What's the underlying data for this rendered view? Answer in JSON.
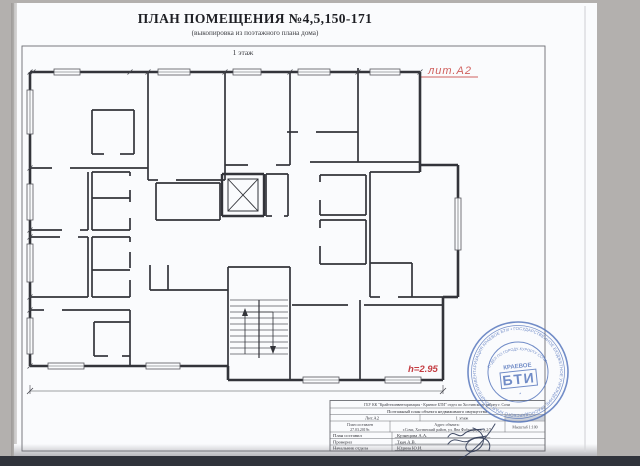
{
  "page": {
    "title": "ПЛАН ПОМЕЩЕНИЯ №4,5,150-171",
    "subtitle": "(выкопировка из поэтажного плана дома)",
    "floor_label": "1 этаж",
    "lit_label": "лит.А2",
    "height_label": "h=2.95"
  },
  "colors": {
    "paper": "#fafbfd",
    "background": "#b3b0ae",
    "wall": "#33343a",
    "dimension_text": "#45464d",
    "room_number_red": "#b8504f",
    "accent_red": "#c43c42",
    "stamp_blue": "#4b6db8",
    "bottom_band": "#30333b"
  },
  "plan": {
    "rooms": [
      {
        "n": "159",
        "a": "16.2",
        "x": 63,
        "y": 110
      },
      {
        "n": "160",
        "a": "2.2",
        "x": 108,
        "y": 116
      },
      {
        "n": "161",
        "a": "17.3",
        "x": 177,
        "y": 106
      },
      {
        "n": "164",
        "a": "13.0",
        "x": 250,
        "y": 112
      },
      {
        "n": "165",
        "a": "9.2",
        "x": 321,
        "y": 94
      },
      {
        "n": "166",
        "a": "13.8",
        "x": 383,
        "y": 110
      },
      {
        "n": "158",
        "a": "1.7",
        "x": 106,
        "y": 177
      },
      {
        "n": "156",
        "a": "7.0",
        "x": 60,
        "y": 199
      },
      {
        "n": "157",
        "a": "2.3",
        "x": 107,
        "y": 210
      },
      {
        "n": "162",
        "a": "5.6",
        "x": 192,
        "y": 192
      },
      {
        "n": "163",
        "a": "1.5",
        "x": 276,
        "y": 192
      },
      {
        "n": "167",
        "a": "4.2",
        "x": 343,
        "y": 186
      },
      {
        "n": "168",
        "a": "4.2",
        "x": 343,
        "y": 234
      },
      {
        "n": "169",
        "a": "18.6",
        "x": 414,
        "y": 220
      },
      {
        "n": "155",
        "a": "6.9",
        "x": 58,
        "y": 260
      },
      {
        "n": "154",
        "a": "2.3",
        "x": 108,
        "y": 246
      },
      {
        "n": "153",
        "a": "1.8",
        "x": 107,
        "y": 279
      },
      {
        "n": "152",
        "a": "13.5",
        "x": 65,
        "y": 336
      },
      {
        "n": "151",
        "a": "2.2",
        "x": 108,
        "y": 336
      },
      {
        "n": "150",
        "a": "17.3",
        "x": 182,
        "y": 335
      },
      {
        "n": "4",
        "a": "43.2",
        "x": 255,
        "y": 242
      },
      {
        "n": "5",
        "a": "9.2",
        "x": 250,
        "y": 362
      },
      {
        "n": "171",
        "a": "14.3",
        "x": 324,
        "y": 334
      },
      {
        "n": "170",
        "a": "15.4",
        "x": 413,
        "y": 334
      }
    ],
    "dims": [
      {
        "t": "4.21",
        "x": 110,
        "y": 69
      },
      {
        "t": "4.14",
        "x": 197,
        "y": 69
      },
      {
        "t": "2.86",
        "x": 253,
        "y": 71
      },
      {
        "t": "3.23",
        "x": 322,
        "y": 70
      },
      {
        "t": "1.75",
        "x": 103,
        "y": 100
      },
      {
        "t": "1.56",
        "x": 100,
        "y": 113
      },
      {
        "t": "1.45",
        "x": 139,
        "y": 132
      },
      {
        "t": "1.49",
        "x": 268,
        "y": 138
      },
      {
        "t": "1.75",
        "x": 343,
        "y": 137
      },
      {
        "t": "4.16",
        "x": 366,
        "y": 158
      },
      {
        "t": "1.90",
        "x": 444,
        "y": 162
      },
      {
        "t": "2.97",
        "x": 191,
        "y": 182
      },
      {
        "t": "2.52",
        "x": 61,
        "y": 176
      },
      {
        "t": "1.57",
        "x": 107,
        "y": 192
      },
      {
        "t": "1.65",
        "x": 96,
        "y": 203
      },
      {
        "t": "2.50",
        "x": 61,
        "y": 242
      },
      {
        "t": "1.56",
        "x": 107,
        "y": 237
      },
      {
        "t": "1.60",
        "x": 108,
        "y": 272
      },
      {
        "t": ".80",
        "x": 276,
        "y": 178
      },
      {
        "t": "2.00",
        "x": 342,
        "y": 173
      },
      {
        "t": "2.00",
        "x": 342,
        "y": 219
      },
      {
        "t": "3.78",
        "x": 412,
        "y": 186
      },
      {
        "t": "6.18",
        "x": 219,
        "y": 227
      },
      {
        "t": "3.10",
        "x": 190,
        "y": 267
      },
      {
        "t": "1.67",
        "x": 391,
        "y": 259
      },
      {
        "t": "3.99",
        "x": 363,
        "y": 272
      },
      {
        "t": "1.40",
        "x": 391,
        "y": 288
      },
      {
        "t": "3.65",
        "x": 337,
        "y": 288
      },
      {
        "t": "3.63",
        "x": 330,
        "y": 303
      },
      {
        "t": "3.90",
        "x": 415,
        "y": 301
      },
      {
        "t": "1.15",
        "x": 244,
        "y": 302
      },
      {
        "t": "4.20",
        "x": 77,
        "y": 306
      },
      {
        "t": "1.76",
        "x": 101,
        "y": 318
      },
      {
        "t": "1.22",
        "x": 140,
        "y": 316
      },
      {
        "t": "1.56",
        "x": 100,
        "y": 329
      },
      {
        "t": "1.38",
        "x": 142,
        "y": 331
      },
      {
        "t": "4.13",
        "x": 173,
        "y": 378
      },
      {
        "t": "2.35",
        "x": 244,
        "y": 378
      },
      {
        "t": "20.40",
        "x": 244,
        "y": 399
      },
      {
        "t": "4.58",
        "x": 36,
        "y": 120,
        "r": 1
      },
      {
        "t": "1.76",
        "x": 82,
        "y": 128,
        "r": 1
      },
      {
        "t": "1.43",
        "x": 119,
        "y": 128,
        "r": 1
      },
      {
        "t": "4.82",
        "x": 213,
        "y": 120,
        "r": 1
      },
      {
        "t": "1.70",
        "x": 165,
        "y": 152,
        "r": 1
      },
      {
        "t": "2.86",
        "x": 352,
        "y": 98,
        "r": 1
      },
      {
        "t": "3.04",
        "x": 367,
        "y": 97,
        "r": 1
      },
      {
        "t": "4.55",
        "x": 279,
        "y": 114,
        "r": 1
      },
      {
        "t": "4.54",
        "x": 407,
        "y": 111,
        "r": 1
      },
      {
        "t": "5.01",
        "x": 428,
        "y": 111,
        "r": 1
      },
      {
        "t": "1.12",
        "x": 95,
        "y": 181,
        "r": 1
      },
      {
        "t": "2.79",
        "x": 86,
        "y": 204,
        "r": 1
      },
      {
        "t": "1.49",
        "x": 122,
        "y": 214,
        "r": 1
      },
      {
        "t": "1.87",
        "x": 219,
        "y": 197,
        "r": 1
      },
      {
        "t": "1.92",
        "x": 283,
        "y": 197,
        "r": 1
      },
      {
        "t": "4.00",
        "x": 294,
        "y": 182,
        "r": 1
      },
      {
        "t": "6.20",
        "x": 315,
        "y": 202,
        "r": 1
      },
      {
        "t": "2.08",
        "x": 362,
        "y": 189,
        "r": 1
      },
      {
        "t": "2.09",
        "x": 362,
        "y": 239,
        "r": 1
      },
      {
        "t": "8.42",
        "x": 134,
        "y": 232,
        "r": 1
      },
      {
        "t": "2.76",
        "x": 86,
        "y": 267,
        "r": 1
      },
      {
        "t": "1.48",
        "x": 122,
        "y": 251,
        "r": 1
      },
      {
        "t": "1.16",
        "x": 95,
        "y": 282,
        "r": 1
      },
      {
        "t": "5.37",
        "x": 448,
        "y": 237,
        "r": 1
      },
      {
        "t": "1.16",
        "x": 400,
        "y": 275,
        "r": 1
      },
      {
        "t": "1.34",
        "x": 413,
        "y": 277,
        "r": 1
      },
      {
        "t": "2.30",
        "x": 152,
        "y": 301,
        "r": 1
      },
      {
        "t": "2.31",
        "x": 165,
        "y": 300,
        "r": 1
      },
      {
        "t": "3.94",
        "x": 38,
        "y": 342,
        "r": 1
      },
      {
        "t": "1.73",
        "x": 84,
        "y": 342,
        "r": 1
      },
      {
        "t": "1.43",
        "x": 121,
        "y": 342,
        "r": 1
      },
      {
        "t": "4.97",
        "x": 215,
        "y": 332,
        "r": 1
      },
      {
        "t": "3.93",
        "x": 361,
        "y": 340,
        "r": 1
      },
      {
        "t": "3.95",
        "x": 447,
        "y": 337,
        "r": 1
      }
    ],
    "walls": [
      [
        30,
        72,
        420,
        72,
        2.6
      ],
      [
        420,
        72,
        420,
        172,
        2.6
      ],
      [
        420,
        165,
        458,
        165,
        2.6
      ],
      [
        458,
        165,
        458,
        297,
        2.6
      ],
      [
        458,
        297,
        443,
        297,
        2.6
      ],
      [
        443,
        297,
        443,
        380,
        2.6
      ],
      [
        443,
        380,
        228,
        380,
        2.6
      ],
      [
        228,
        380,
        228,
        366,
        2.6
      ],
      [
        228,
        366,
        30,
        366,
        2.6
      ],
      [
        30,
        366,
        30,
        72,
        2.6
      ],
      [
        148,
        72,
        148,
        180
      ],
      [
        225,
        72,
        225,
        180
      ],
      [
        290,
        72,
        290,
        165
      ],
      [
        358,
        68,
        358,
        162
      ],
      [
        287,
        132,
        298,
        132
      ],
      [
        316,
        132,
        358,
        132
      ],
      [
        310,
        162,
        420,
        162
      ],
      [
        148,
        180,
        158,
        180
      ],
      [
        176,
        180,
        225,
        180
      ],
      [
        225,
        165,
        248,
        165
      ],
      [
        276,
        165,
        290,
        165
      ],
      [
        30,
        168,
        52,
        168
      ],
      [
        70,
        168,
        148,
        168
      ],
      [
        92,
        110,
        134,
        110
      ],
      [
        92,
        110,
        92,
        154
      ],
      [
        134,
        110,
        134,
        154
      ],
      [
        92,
        154,
        104,
        154
      ],
      [
        120,
        154,
        134,
        154
      ],
      [
        88,
        172,
        88,
        230
      ],
      [
        30,
        230,
        62,
        230
      ],
      [
        80,
        230,
        88,
        230
      ],
      [
        92,
        172,
        130,
        172
      ],
      [
        92,
        172,
        92,
        230
      ],
      [
        92,
        198,
        130,
        198
      ],
      [
        92,
        230,
        130,
        230
      ],
      [
        130,
        172,
        130,
        176
      ],
      [
        130,
        190,
        130,
        202
      ],
      [
        130,
        218,
        130,
        230
      ],
      [
        88,
        237,
        88,
        297
      ],
      [
        30,
        237,
        60,
        237
      ],
      [
        78,
        237,
        88,
        237
      ],
      [
        30,
        297,
        88,
        297
      ],
      [
        92,
        237,
        130,
        237
      ],
      [
        92,
        237,
        92,
        297
      ],
      [
        92,
        270,
        130,
        270
      ],
      [
        92,
        297,
        130,
        297
      ],
      [
        130,
        237,
        130,
        242
      ],
      [
        130,
        252,
        130,
        268
      ],
      [
        130,
        280,
        130,
        297
      ],
      [
        30,
        310,
        44,
        310
      ],
      [
        62,
        310,
        130,
        310
      ],
      [
        130,
        310,
        130,
        366
      ],
      [
        94,
        322,
        130,
        322
      ],
      [
        94,
        322,
        94,
        356
      ],
      [
        94,
        356,
        108,
        356
      ],
      [
        122,
        356,
        130,
        356
      ],
      [
        150,
        265,
        150,
        290
      ],
      [
        168,
        265,
        168,
        290
      ],
      [
        150,
        290,
        228,
        290
      ],
      [
        156,
        183,
        220,
        183
      ],
      [
        156,
        183,
        156,
        220
      ],
      [
        156,
        220,
        220,
        220
      ],
      [
        220,
        183,
        220,
        220
      ],
      [
        222,
        174,
        264,
        174,
        2.4
      ],
      [
        222,
        174,
        222,
        216,
        2.4
      ],
      [
        264,
        174,
        264,
        216,
        2.4
      ],
      [
        222,
        216,
        264,
        216,
        2.4
      ],
      [
        266,
        174,
        288,
        174
      ],
      [
        288,
        174,
        288,
        216
      ],
      [
        266,
        174,
        266,
        216
      ],
      [
        266,
        216,
        272,
        216
      ],
      [
        284,
        216,
        288,
        216
      ],
      [
        320,
        175,
        366,
        175
      ],
      [
        320,
        175,
        320,
        182
      ],
      [
        320,
        200,
        320,
        215
      ],
      [
        320,
        215,
        366,
        215
      ],
      [
        366,
        175,
        366,
        215
      ],
      [
        320,
        220,
        366,
        220
      ],
      [
        320,
        220,
        320,
        228
      ],
      [
        320,
        246,
        320,
        264
      ],
      [
        320,
        264,
        366,
        264
      ],
      [
        366,
        220,
        366,
        264
      ],
      [
        370,
        172,
        420,
        172
      ],
      [
        370,
        172,
        370,
        297
      ],
      [
        370,
        263,
        412,
        263
      ],
      [
        412,
        263,
        412,
        297
      ],
      [
        370,
        297,
        380,
        297
      ],
      [
        398,
        297,
        443,
        297
      ],
      [
        228,
        267,
        228,
        380
      ],
      [
        290,
        267,
        290,
        380
      ],
      [
        228,
        267,
        290,
        267
      ],
      [
        292,
        305,
        348,
        305
      ],
      [
        364,
        305,
        443,
        305
      ],
      [
        360,
        300,
        360,
        380
      ]
    ],
    "windows": [
      [
        54,
        69,
        26,
        6
      ],
      [
        158,
        69,
        32,
        6
      ],
      [
        233,
        69,
        28,
        6
      ],
      [
        298,
        69,
        32,
        6
      ],
      [
        370,
        69,
        30,
        6
      ],
      [
        27,
        90,
        6,
        44
      ],
      [
        27,
        184,
        6,
        36
      ],
      [
        27,
        244,
        6,
        38
      ],
      [
        27,
        318,
        6,
        36
      ],
      [
        455,
        198,
        6,
        52
      ],
      [
        48,
        363,
        36,
        6
      ],
      [
        146,
        363,
        34,
        6
      ],
      [
        303,
        377,
        36,
        6
      ],
      [
        385,
        377,
        36,
        6
      ]
    ],
    "stairs": {
      "x1": 230,
      "x2": 288,
      "y1": 300,
      "y2": 358,
      "step": 6,
      "cx": 259,
      "a1": 245,
      "a2": 273
    },
    "elevator": {
      "x": 228,
      "y": 179,
      "w": 30,
      "h": 32
    },
    "baseline": [
      30,
      391,
      443,
      391
    ],
    "ticks_top": [
      33,
      130,
      148,
      225,
      290,
      358,
      420
    ],
    "ticks_left": [
      72,
      168,
      230,
      237,
      297,
      310,
      366
    ]
  },
  "titleblock": {
    "org": "ГБУ КК \"Крайтехинвентаризация - Краевое БТИ\" отдел по Хостинскому району г. Сочи",
    "doc_type": "Поэтажный план объекта недвижимого имущества",
    "lit": "Лит.А2",
    "floor": "1 этаж",
    "made_label": "План составлен",
    "made_date": "27.03.2019г.",
    "address_label": "Адрес объекта:",
    "address": "г.Сочи, Хостинский район, ул. Яна Фабрициуса, д.2/5",
    "scale_label": "Масштаб 1:100",
    "rows": [
      {
        "label": "План составил",
        "name": "Кузнецова А.А."
      },
      {
        "label": "Проверил",
        "name": "Ткач А.В."
      },
      {
        "label": "Начальник отдела",
        "name": "Юдина Ю.И."
      }
    ]
  },
  "stamp": {
    "ring_text": "ГОСУДАРСТВЕННОЕ БЮДЖЕТНОЕ УЧРЕЖДЕНИЕ КРАСНОДАРСКОГО КРАЯ • КРАЙТЕХИНВЕНТАРИЗАЦИЯ КРАЕВОЕ БТИ •",
    "inner_text": "ОТДЕЛ ПО ГОРОДУ-КУРОРТУ СОЧИ",
    "center_top": "КРАЕВОЕ",
    "center_main": "БТИ"
  }
}
